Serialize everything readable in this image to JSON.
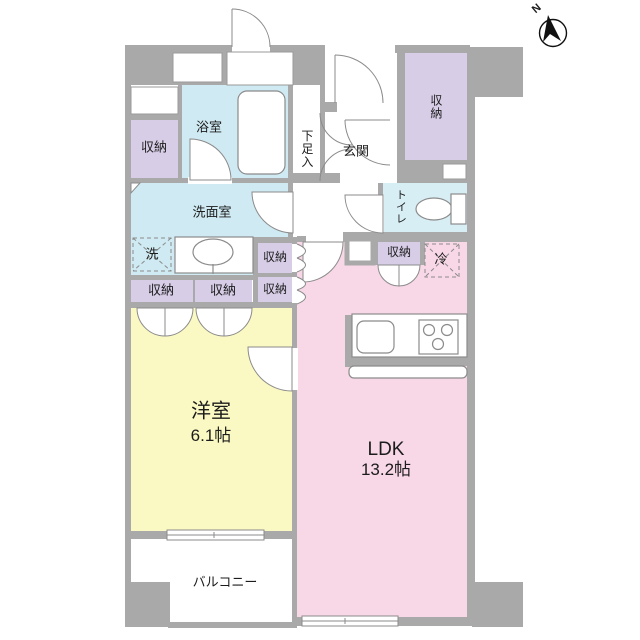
{
  "labels": {
    "bathroom": "浴室",
    "washroom": "洗面室",
    "toilet": "トイレ",
    "genkan": "玄関",
    "shoe_cabinet": "下足入",
    "storage": "収納",
    "washer": "洗",
    "fridge": "冷",
    "western_room": "洋室",
    "western_room_size": "6.1帖",
    "ldk": "LDK",
    "ldk_size": "13.2帖",
    "balcony": "バルコニー",
    "compass": "N"
  },
  "colors": {
    "wall": "#a9a9a9",
    "water_room": "#cfeaf2",
    "toilet_room": "#d8eef5",
    "storage_room": "#d7cde7",
    "western_room": "#fbf9c3",
    "ldk_room": "#f8d7e7",
    "line": "#8b8b8b",
    "white": "#ffffff"
  }
}
